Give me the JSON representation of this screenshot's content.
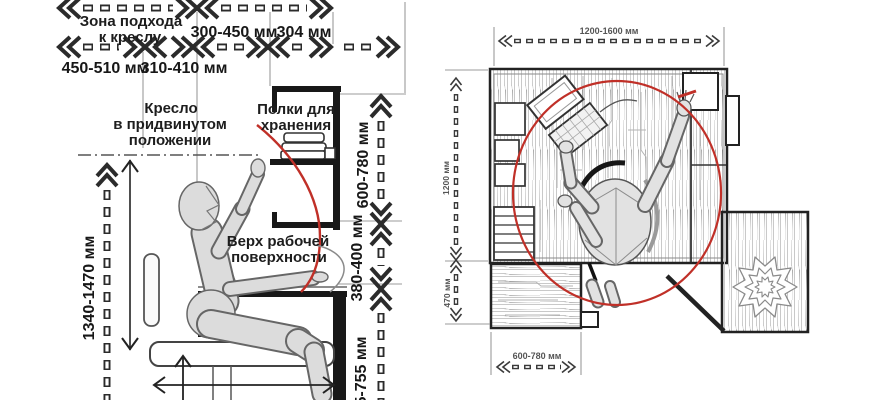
{
  "left_diagram": {
    "approach_zone_label": {
      "line1": "Зона подхода",
      "line2": "к креслу"
    },
    "top_dimensions": {
      "row1_dim1": "300-450 мм",
      "row1_dim2": "304 мм",
      "row2_dim1": "450-510 мм",
      "row2_dim2": "310-410 мм"
    },
    "chair_label": {
      "line1": "Кресло",
      "line2": "в придвинутом",
      "line3": "положении"
    },
    "shelves_label": {
      "line1": "Полки для",
      "line2": "хранения"
    },
    "worktop_label": {
      "line1": "Верх рабочей",
      "line2": "поверхности"
    },
    "vertical_dimensions": {
      "shelf_zone": "600-780 мм",
      "shelf_to_desk": "380-400 мм",
      "reach_height": "1340-1470 мм",
      "desk_height_partial": "5-755 мм"
    }
  },
  "right_diagram": {
    "dimensions": {
      "desk_width": "1200-1600 мм",
      "desk_depth": "1200 мм",
      "cabinet_offset": "470 мм",
      "cabinet_width": "600-780 мм"
    }
  },
  "colors": {
    "background": "#ffffff",
    "line_art": "#222222",
    "reach_arc_red": "#c03028",
    "figure_fill": "#dcdcdc",
    "wood_grain": "#c9c9c9",
    "dimension_text": "#1d1d1d",
    "small_dimension_text": "#555555"
  }
}
